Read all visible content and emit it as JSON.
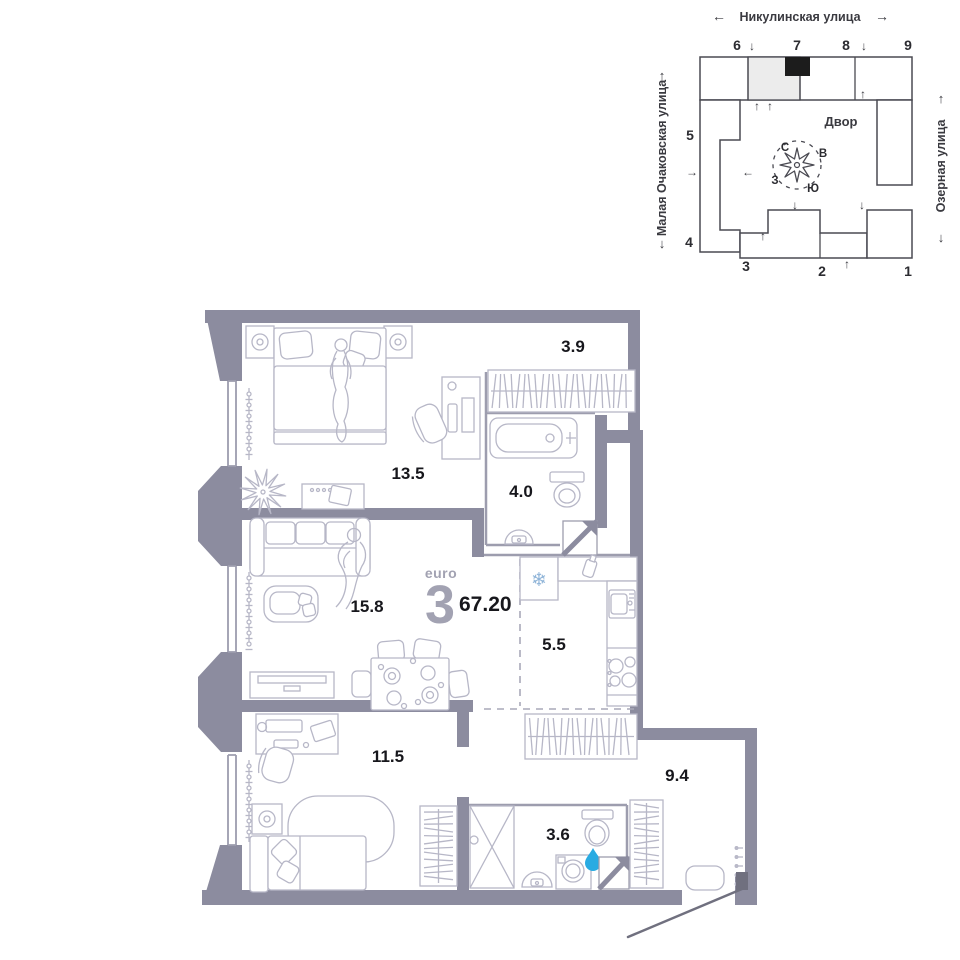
{
  "site_plan": {
    "street_top": "Никулинская улица",
    "street_left": "Малая Очаковская улица",
    "street_right": "Озерная улица",
    "courtyard_label": "Двор",
    "compass": {
      "n": "С",
      "e": "В",
      "w": "З",
      "s": "Ю"
    },
    "buildings": {
      "b1": "1",
      "b2": "2",
      "b3": "3",
      "b4": "4",
      "b5": "5",
      "b6": "6",
      "b7": "7",
      "b8": "8",
      "b9": "9"
    },
    "arrows": {
      "up": "↑",
      "down": "↓",
      "left": "←",
      "right": "→"
    }
  },
  "apartment": {
    "type_label": "euro",
    "rooms_count": "3",
    "total_area": "67.20"
  },
  "room_areas": {
    "wardrobe": "3.9",
    "bedroom": "13.5",
    "bathroom": "4.0",
    "living_room": "15.8",
    "kitchen": "5.5",
    "bedroom_2": "11.5",
    "hallway": "9.4",
    "bathroom_2": "3.6"
  },
  "icons": {
    "snowflake_glyph": "❄"
  },
  "colors": {
    "wall": "#8c8c9f",
    "furniture_line": "#b7b7c7",
    "water_drop": "#29abe2",
    "site_outline": "#4a4a52",
    "marker": "#1c1c1c"
  }
}
